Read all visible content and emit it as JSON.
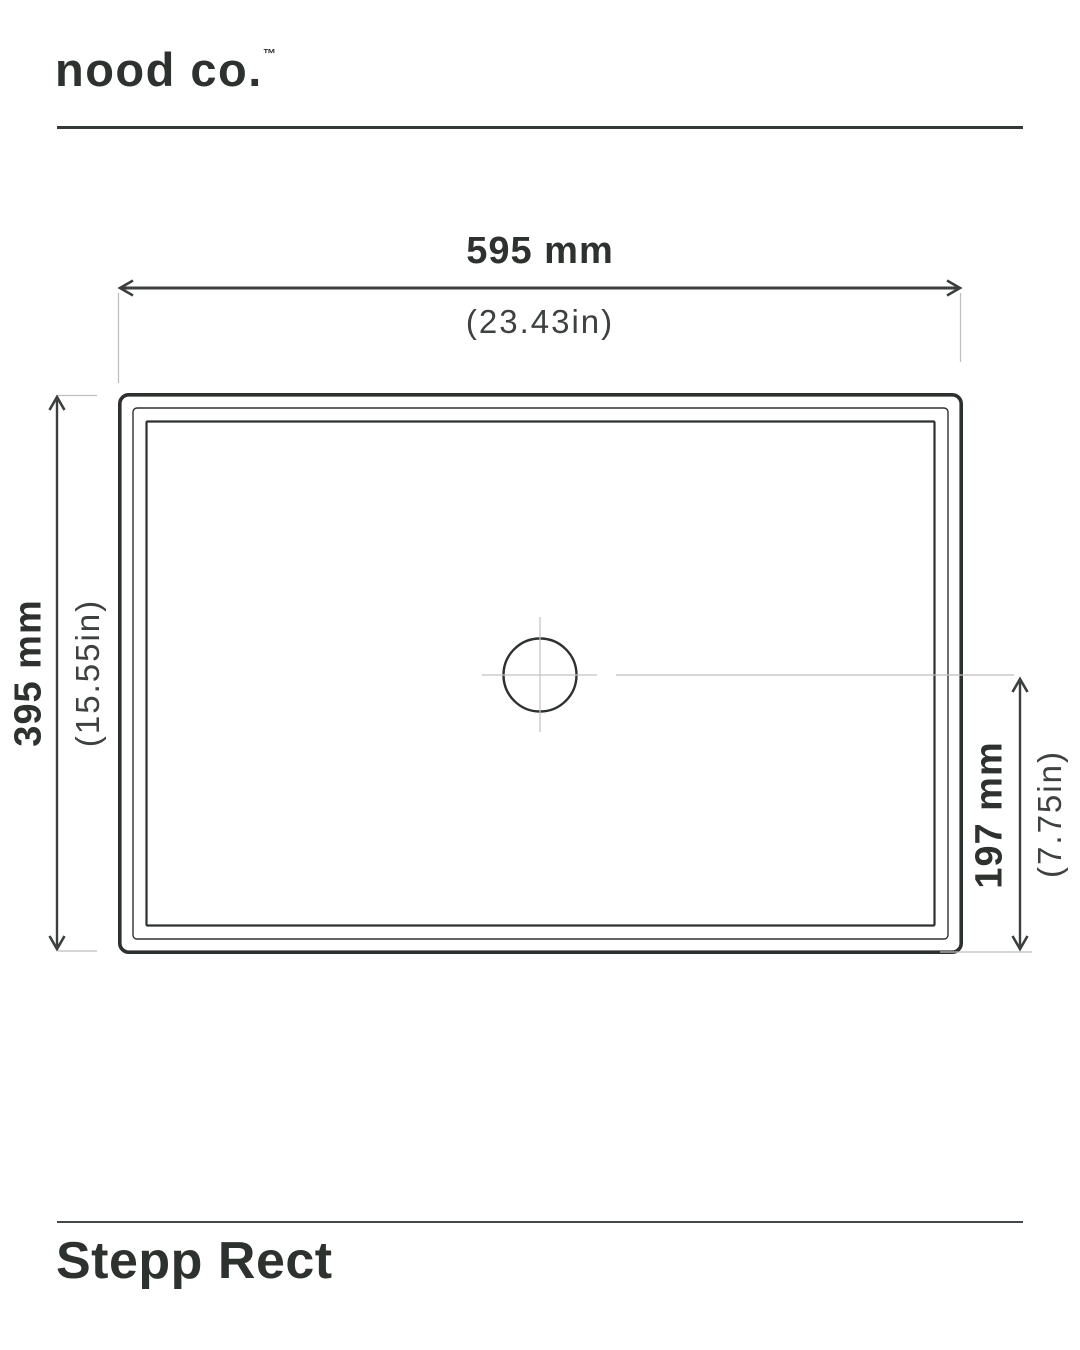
{
  "colors": {
    "ink": "#2e322f",
    "line_dark": "#343835",
    "line_light": "#bcbebc"
  },
  "header": {
    "logo": "nood co.",
    "trademark": "™"
  },
  "dimensions": {
    "width": {
      "metric": "595 mm",
      "imperial": "(23.43in)"
    },
    "height": {
      "metric": "395 mm",
      "imperial": "(15.55in)"
    },
    "drain_offset": {
      "metric": "197 mm",
      "imperial": "(7.75in)"
    }
  },
  "product": {
    "name": "Stepp Rect"
  }
}
